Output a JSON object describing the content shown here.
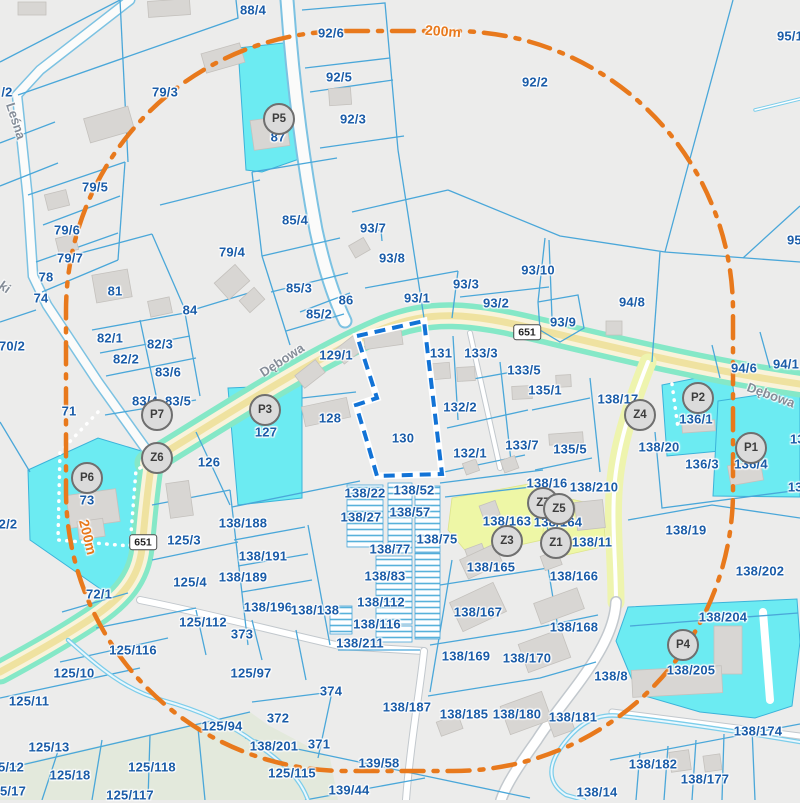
{
  "map": {
    "colors": {
      "background": "#ececeb",
      "parcel_line": "#4aa7d9",
      "label_text": "#1a5ca8",
      "highlight_cyan": "#6cebf2",
      "highlight_yellow": "#eef7a6",
      "road_teal_edge": "#85e8c7",
      "road_yellow_center": "#efe2a0",
      "minor_road_yellow": "#eef4ae",
      "buffer_orange": "#e8791c",
      "selected_parcel_dash": "#1273d6",
      "building_gray": "#d8d6d3",
      "stream_blue": "#7ccdea",
      "green_area": "#e3e9dc"
    },
    "street_labels": [
      {
        "text": "Dębowa",
        "x": 282,
        "y": 360,
        "rot": -33
      },
      {
        "text": "Dębowa",
        "x": 771,
        "y": 395,
        "rot": 20
      },
      {
        "text": "Leśna",
        "x": 16,
        "y": 121,
        "rot": 72
      },
      {
        "text": "ki",
        "x": 5,
        "y": 287,
        "rot": 35
      }
    ],
    "buffer_labels": [
      {
        "text": "200m",
        "x": 443,
        "y": 31,
        "rot": 4
      },
      {
        "text": "200m",
        "x": 88,
        "y": 537,
        "rot": 76
      }
    ],
    "road_badges": [
      {
        "text": "651",
        "x": 527,
        "y": 332
      },
      {
        "text": "651",
        "x": 143,
        "y": 542
      }
    ],
    "markers": [
      {
        "id": "P5",
        "x": 279,
        "y": 119
      },
      {
        "id": "P7",
        "x": 157,
        "y": 415
      },
      {
        "id": "Z6",
        "x": 157,
        "y": 458
      },
      {
        "id": "P6",
        "x": 87,
        "y": 478
      },
      {
        "id": "P3",
        "x": 265,
        "y": 410
      },
      {
        "id": "Z4",
        "x": 640,
        "y": 415
      },
      {
        "id": "P2",
        "x": 698,
        "y": 398
      },
      {
        "id": "P1",
        "x": 751,
        "y": 448
      },
      {
        "id": "Z7",
        "x": 543,
        "y": 503
      },
      {
        "id": "Z5",
        "x": 559,
        "y": 509
      },
      {
        "id": "Z3",
        "x": 507,
        "y": 541
      },
      {
        "id": "Z1",
        "x": 556,
        "y": 543
      },
      {
        "id": "P4",
        "x": 683,
        "y": 645
      }
    ],
    "parcel_labels": [
      {
        "text": "88/4",
        "x": 253,
        "y": 10
      },
      {
        "text": "92/6",
        "x": 331,
        "y": 33
      },
      {
        "text": "92/5",
        "x": 339,
        "y": 77
      },
      {
        "text": "92/3",
        "x": 353,
        "y": 119
      },
      {
        "text": "87",
        "x": 278,
        "y": 137
      },
      {
        "text": "79/3",
        "x": 165,
        "y": 92
      },
      {
        "text": "/2",
        "x": 7,
        "y": 92
      },
      {
        "text": "92/2",
        "x": 535,
        "y": 82
      },
      {
        "text": "95/1",
        "x": 790,
        "y": 36
      },
      {
        "text": "95/7",
        "x": 800,
        "y": 240
      },
      {
        "text": "79/5",
        "x": 95,
        "y": 187
      },
      {
        "text": "79/6",
        "x": 67,
        "y": 230
      },
      {
        "text": "79/7",
        "x": 70,
        "y": 258
      },
      {
        "text": "78",
        "x": 46,
        "y": 277
      },
      {
        "text": "74",
        "x": 41,
        "y": 298
      },
      {
        "text": "81",
        "x": 115,
        "y": 291
      },
      {
        "text": "84",
        "x": 190,
        "y": 310
      },
      {
        "text": "79/4",
        "x": 232,
        "y": 252
      },
      {
        "text": "85/4",
        "x": 295,
        "y": 220
      },
      {
        "text": "93/7",
        "x": 373,
        "y": 228
      },
      {
        "text": "93/8",
        "x": 392,
        "y": 258
      },
      {
        "text": "85/3",
        "x": 299,
        "y": 288
      },
      {
        "text": "86",
        "x": 346,
        "y": 300
      },
      {
        "text": "85/2",
        "x": 319,
        "y": 314
      },
      {
        "text": "93/1",
        "x": 417,
        "y": 298
      },
      {
        "text": "93/3",
        "x": 466,
        "y": 284
      },
      {
        "text": "93/2",
        "x": 496,
        "y": 303
      },
      {
        "text": "93/10",
        "x": 538,
        "y": 270
      },
      {
        "text": "93/9",
        "x": 563,
        "y": 322
      },
      {
        "text": "94/8",
        "x": 632,
        "y": 302
      },
      {
        "text": "70/2",
        "x": 12,
        "y": 346
      },
      {
        "text": "82/1",
        "x": 110,
        "y": 338
      },
      {
        "text": "82/3",
        "x": 160,
        "y": 344
      },
      {
        "text": "82/2",
        "x": 126,
        "y": 359
      },
      {
        "text": "83/6",
        "x": 168,
        "y": 372
      },
      {
        "text": "83/4",
        "x": 145,
        "y": 401
      },
      {
        "text": "83/5",
        "x": 178,
        "y": 401
      },
      {
        "text": "71",
        "x": 69,
        "y": 411
      },
      {
        "text": "73",
        "x": 87,
        "y": 500
      },
      {
        "text": "126",
        "x": 209,
        "y": 462
      },
      {
        "text": "127",
        "x": 266,
        "y": 432
      },
      {
        "text": "128",
        "x": 330,
        "y": 418
      },
      {
        "text": "129/1",
        "x": 336,
        "y": 355
      },
      {
        "text": "131",
        "x": 441,
        "y": 353
      },
      {
        "text": "133/3",
        "x": 481,
        "y": 353
      },
      {
        "text": "133/5",
        "x": 524,
        "y": 370
      },
      {
        "text": "135/1",
        "x": 545,
        "y": 390
      },
      {
        "text": "132/2",
        "x": 460,
        "y": 407
      },
      {
        "text": "132/1",
        "x": 470,
        "y": 453
      },
      {
        "text": "133/7",
        "x": 522,
        "y": 445
      },
      {
        "text": "135/5",
        "x": 570,
        "y": 449
      },
      {
        "text": "130",
        "x": 403,
        "y": 438
      },
      {
        "text": "138/17",
        "x": 618,
        "y": 399
      },
      {
        "text": "94/6",
        "x": 744,
        "y": 368
      },
      {
        "text": "94/1",
        "x": 786,
        "y": 364
      },
      {
        "text": "136/1",
        "x": 696,
        "y": 419
      },
      {
        "text": "138/20",
        "x": 659,
        "y": 447
      },
      {
        "text": "136/3",
        "x": 702,
        "y": 464
      },
      {
        "text": "136/4",
        "x": 751,
        "y": 464
      },
      {
        "text": "136/",
        "x": 803,
        "y": 439
      },
      {
        "text": "137",
        "x": 799,
        "y": 487
      },
      {
        "text": "138/16",
        "x": 547,
        "y": 483
      },
      {
        "text": "138/210",
        "x": 594,
        "y": 487
      },
      {
        "text": "138/163",
        "x": 507,
        "y": 521
      },
      {
        "text": "138/164",
        "x": 558,
        "y": 522
      },
      {
        "text": "138/11",
        "x": 592,
        "y": 542
      },
      {
        "text": "138/165",
        "x": 491,
        "y": 567
      },
      {
        "text": "138/166",
        "x": 574,
        "y": 576
      },
      {
        "text": "138/19",
        "x": 686,
        "y": 530
      },
      {
        "text": "138/202",
        "x": 760,
        "y": 571
      },
      {
        "text": "138/204",
        "x": 723,
        "y": 617
      },
      {
        "text": "138/205",
        "x": 691,
        "y": 670
      },
      {
        "text": "138/8",
        "x": 611,
        "y": 676
      },
      {
        "text": "138/167",
        "x": 478,
        "y": 612
      },
      {
        "text": "138/168",
        "x": 574,
        "y": 627
      },
      {
        "text": "138/169",
        "x": 466,
        "y": 656
      },
      {
        "text": "138/170",
        "x": 527,
        "y": 658
      },
      {
        "text": "138/185",
        "x": 464,
        "y": 714
      },
      {
        "text": "138/180",
        "x": 517,
        "y": 714
      },
      {
        "text": "138/181",
        "x": 573,
        "y": 717
      },
      {
        "text": "138/174",
        "x": 758,
        "y": 731
      },
      {
        "text": "138/182",
        "x": 653,
        "y": 764
      },
      {
        "text": "138/177",
        "x": 705,
        "y": 779
      },
      {
        "text": "138/14",
        "x": 597,
        "y": 792
      },
      {
        "text": "138/22",
        "x": 365,
        "y": 493
      },
      {
        "text": "138/52",
        "x": 414,
        "y": 490
      },
      {
        "text": "138/27",
        "x": 361,
        "y": 517
      },
      {
        "text": "138/57",
        "x": 410,
        "y": 512
      },
      {
        "text": "138/75",
        "x": 437,
        "y": 539
      },
      {
        "text": "138/77",
        "x": 390,
        "y": 549
      },
      {
        "text": "138/83",
        "x": 385,
        "y": 576
      },
      {
        "text": "138/112",
        "x": 381,
        "y": 602
      },
      {
        "text": "138/116",
        "x": 377,
        "y": 624
      },
      {
        "text": "138/211",
        "x": 360,
        "y": 643
      },
      {
        "text": "138/188",
        "x": 243,
        "y": 523
      },
      {
        "text": "138/191",
        "x": 263,
        "y": 556
      },
      {
        "text": "138/189",
        "x": 243,
        "y": 577
      },
      {
        "text": "138/196",
        "x": 268,
        "y": 607
      },
      {
        "text": "138/138",
        "x": 315,
        "y": 610
      },
      {
        "text": "2/2",
        "x": 8,
        "y": 524
      },
      {
        "text": "125/3",
        "x": 184,
        "y": 540
      },
      {
        "text": "125/4",
        "x": 190,
        "y": 582
      },
      {
        "text": "72/1",
        "x": 99,
        "y": 594
      },
      {
        "text": "125/112",
        "x": 203,
        "y": 622
      },
      {
        "text": "373",
        "x": 242,
        "y": 634
      },
      {
        "text": "125/116",
        "x": 133,
        "y": 650
      },
      {
        "text": "125/10",
        "x": 74,
        "y": 673
      },
      {
        "text": "125/11",
        "x": 29,
        "y": 701
      },
      {
        "text": "125/94",
        "x": 222,
        "y": 726
      },
      {
        "text": "125/97",
        "x": 251,
        "y": 673
      },
      {
        "text": "374",
        "x": 331,
        "y": 691
      },
      {
        "text": "372",
        "x": 278,
        "y": 718
      },
      {
        "text": "138/187",
        "x": 407,
        "y": 707
      },
      {
        "text": "371",
        "x": 319,
        "y": 744
      },
      {
        "text": "138/201",
        "x": 274,
        "y": 746
      },
      {
        "text": "139/58",
        "x": 379,
        "y": 763
      },
      {
        "text": "125/115",
        "x": 292,
        "y": 773
      },
      {
        "text": "139/44",
        "x": 349,
        "y": 790
      },
      {
        "text": "125/13",
        "x": 49,
        "y": 747
      },
      {
        "text": "5/12",
        "x": 11,
        "y": 767
      },
      {
        "text": "125/18",
        "x": 70,
        "y": 775
      },
      {
        "text": "125/118",
        "x": 152,
        "y": 767
      },
      {
        "text": "5/17",
        "x": 13,
        "y": 791
      },
      {
        "text": "125/117",
        "x": 130,
        "y": 795
      }
    ]
  }
}
